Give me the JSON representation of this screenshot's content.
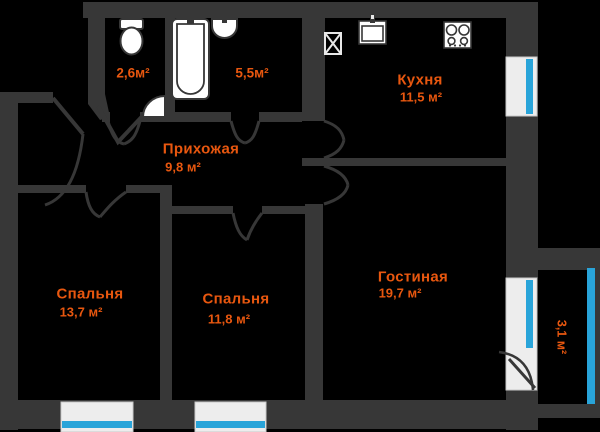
{
  "plan_title": "apartment-floor-plan",
  "colors": {
    "background": "#000000",
    "wall": "#373737",
    "room_label": "#e8570f",
    "window_glass": "#29a4d9",
    "fixture_fill": "#ffffff",
    "window_frame": "#ededed"
  },
  "rooms": [
    {
      "id": "wc",
      "area": "2,6м²"
    },
    {
      "id": "bathroom",
      "area": "5,5м²"
    },
    {
      "id": "kitchen",
      "name": "Кухня",
      "area": "11,5 м²"
    },
    {
      "id": "hallway",
      "name": "Прихожая",
      "area": "9,8 м²"
    },
    {
      "id": "bedroom-1",
      "name": "Спальня",
      "area": "13,7 м²"
    },
    {
      "id": "bedroom-2",
      "name": "Спальня",
      "area": "11,8 м²"
    },
    {
      "id": "living-room",
      "name": "Гостиная",
      "area": "19,7 м²"
    },
    {
      "id": "balcony",
      "area": "3,1 м²"
    }
  ],
  "fixtures": [
    "toilet-icon",
    "bathtub-icon",
    "washbasin-icon",
    "vent-shaft-icon",
    "kitchen-sink-icon",
    "stove-icon",
    "door-swing-icon",
    "window-icon",
    "balcony-door-icon"
  ]
}
